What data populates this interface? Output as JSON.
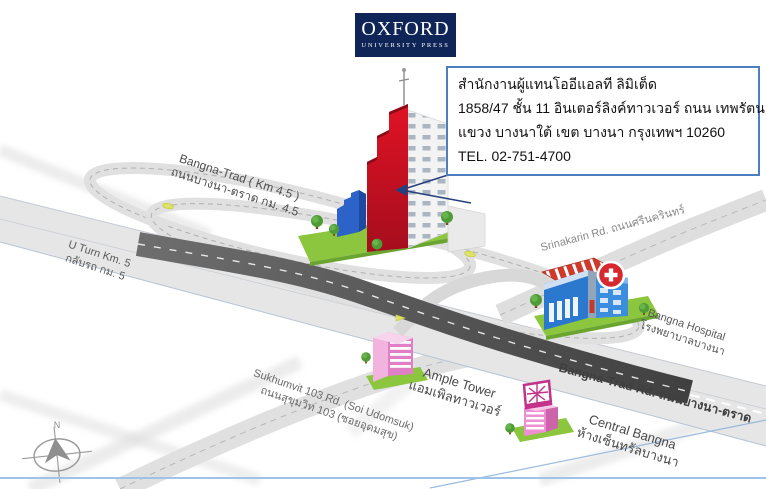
{
  "logo": {
    "title": "OXFORD",
    "subtitle": "UNIVERSITY PRESS"
  },
  "address_box": {
    "line1": "สำนักงานผู้แทนโออีแอลที ลิมิเต็ด",
    "line2": "1858/47 ชั้น 11 อินเตอร์ลิงค์ทาวเวอร์ ถนน เทพรัตน",
    "line3": "แขวง บางนาใต้ เขต บางนา กรุงเทพฯ 10260",
    "line4": "TEL. 02-751-4700"
  },
  "road_labels": {
    "bangna_trad_km": {
      "en": "Bangna-Trad ( Km 4.5 )",
      "th": "ถนนบางนา-ตราด กม. 4.5"
    },
    "u_turn": {
      "en": "U Turn Km. 5",
      "th": "กลับรถ กม. 5"
    },
    "srinakarin": {
      "text": "Srinakarin Rd. ถนนศรีนครินทร์"
    },
    "bangna_trad_rd": {
      "text": "Bangna-Trad Rd. ถนนบางนา-ตราด"
    },
    "sukhumvit": {
      "en": "Sukhumvit 103 Rd. (Soi Udomsuk)",
      "th": "ถนนสุขุมวิท 103 (ซอยอุดมสุข)"
    }
  },
  "places": {
    "bangna_hospital": {
      "en": "Bangna Hospital",
      "th": "โรงพยาบาลบางนา"
    },
    "ample_tower": {
      "en": "Ample Tower",
      "th": "แอมเพิลทาวเวอร์"
    },
    "central_bangna": {
      "en": "Central Bangna",
      "th": "ห้างเซ็นทรัลบางนา"
    }
  },
  "compass": {
    "north": "N"
  },
  "colors": {
    "oxford_blue": "#0f2557",
    "callout_border": "#4d7ebf",
    "tower_red": "#c8102e",
    "annex_blue": "#2d63c8",
    "building_pink": "#e07fc6",
    "hospital_blue": "#2b78cf",
    "hospital_cross_red": "#d7282f",
    "grass_green": "#8cc63e",
    "road_gray": "#e6e6e6",
    "asphalt_dark": "#4f4f4f",
    "footer_line_blue": "#9dc3e6"
  }
}
